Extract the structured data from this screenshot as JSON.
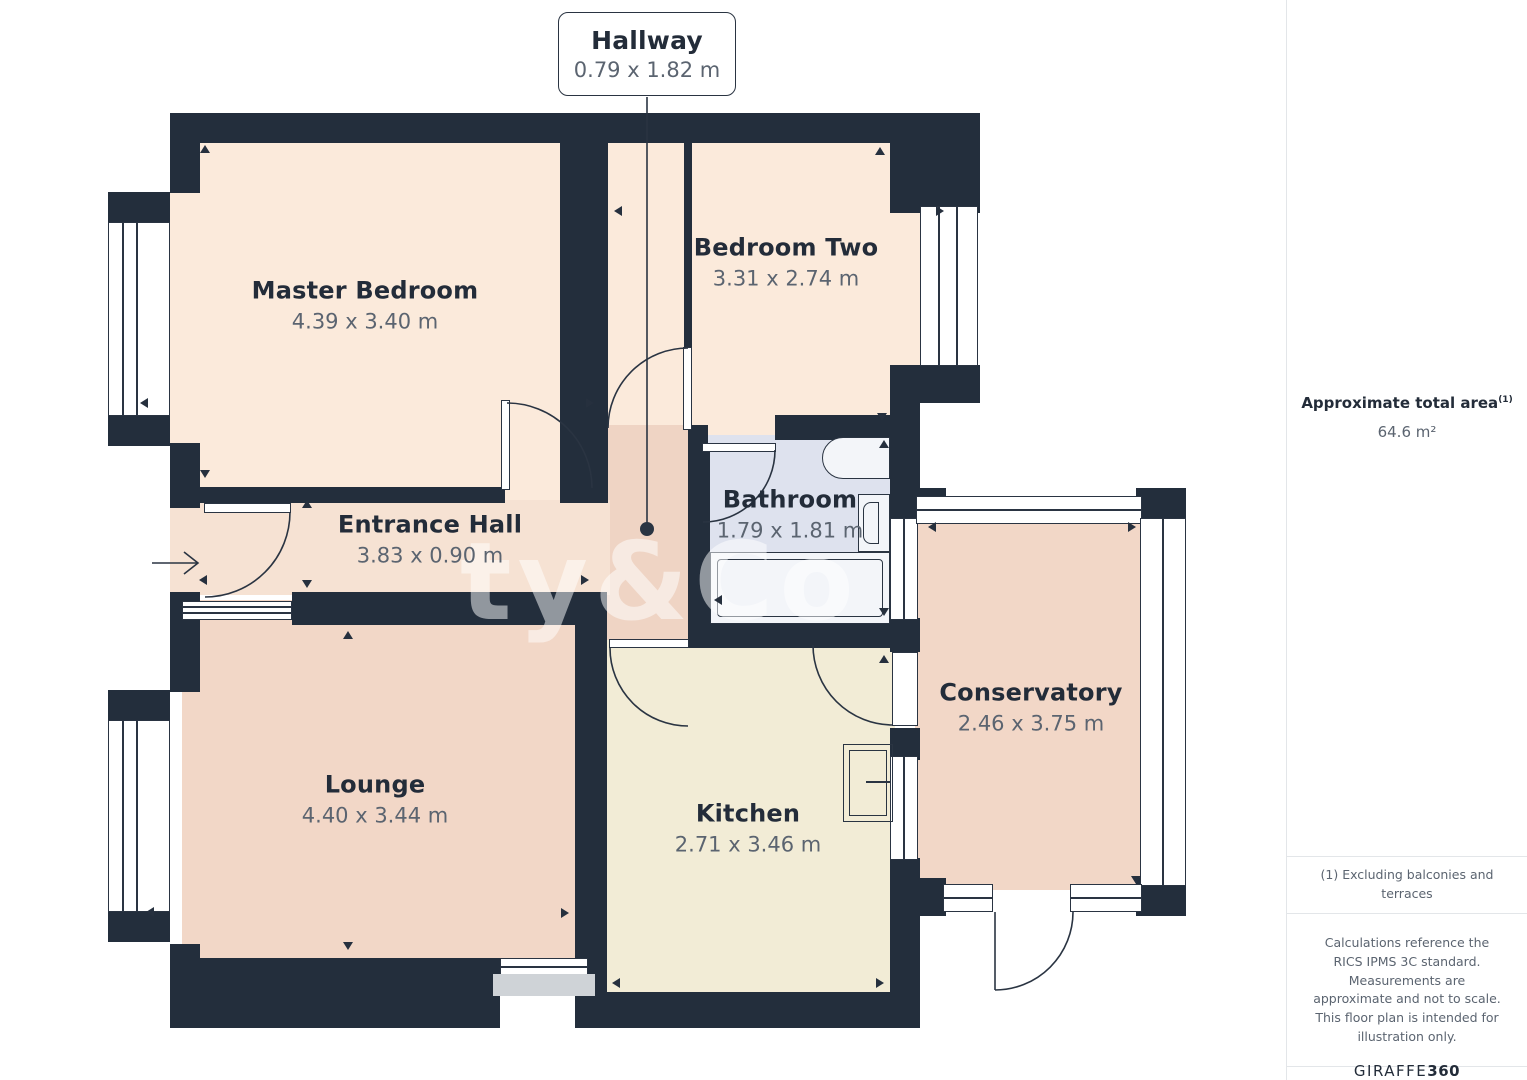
{
  "callout": {
    "name": "Hallway",
    "dims": "0.79 x 1.82 m"
  },
  "rooms": {
    "master_bedroom": {
      "name": "Master Bedroom",
      "dims": "4.39 x 3.40 m"
    },
    "bedroom_two": {
      "name": "Bedroom Two",
      "dims": "3.31 x 2.74 m"
    },
    "bathroom": {
      "name": "Bathroom",
      "dims": "1.79 x 1.81 m"
    },
    "entrance_hall": {
      "name": "Entrance Hall",
      "dims": "3.83 x 0.90 m"
    },
    "lounge": {
      "name": "Lounge",
      "dims": "4.40 x 3.44 m"
    },
    "kitchen": {
      "name": "Kitchen",
      "dims": "2.71 x 3.46 m"
    },
    "conservatory": {
      "name": "Conservatory",
      "dims": "2.46 x 3.75 m"
    }
  },
  "sidebar": {
    "total_area_label": "Approximate total area",
    "total_area_superscript": "(1)",
    "total_area_value": "64.6 m²",
    "footnote": "(1) Excluding balconies and terraces",
    "disclaimer": "Calculations reference the RICS IPMS 3C standard. Measurements are approximate and not to scale. This floor plan is intended for illustration only.",
    "brand_regular": "GIRAFFE",
    "brand_bold": "360"
  },
  "watermark": "ty&Co",
  "colors": {
    "wall": "#232E3C",
    "line": "#2A3442",
    "bedroom": "#FBEADB",
    "lounge": "#F2D7C7",
    "hallway": "#EFD4C4",
    "entrance": "#F6E2D3",
    "kitchen": "#F2ECD6",
    "bathroom": "#DEE2EE",
    "fixture": "#F3F5F9",
    "sill": "#CFD3D7",
    "textdark": "#232C39",
    "textgray": "#5B6470",
    "borderlight": "#E3E6E9",
    "watermark": "rgba(255,255,255,0.5)"
  }
}
